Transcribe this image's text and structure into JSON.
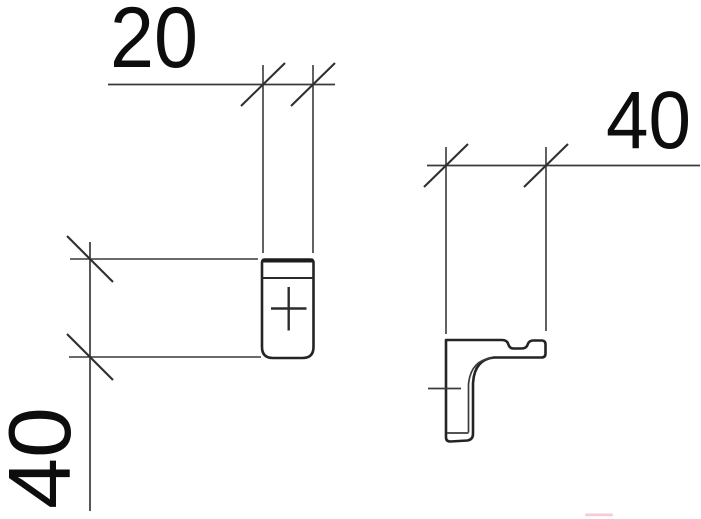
{
  "dimensions": {
    "top_width": "20",
    "left_height": "40",
    "right_depth": "40"
  },
  "colors": {
    "background": "#ffffff",
    "outline": "#242424",
    "dimension_lines": "#3a3a3a",
    "text": "#0d0d0d",
    "artifact_pink": "#f2c3ce"
  }
}
